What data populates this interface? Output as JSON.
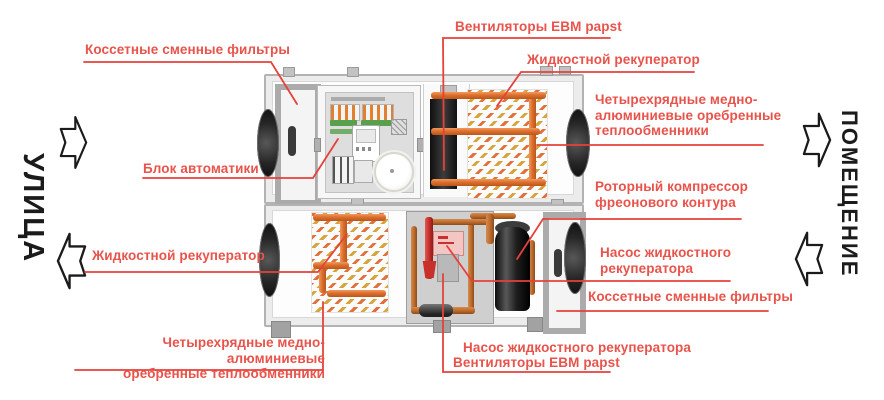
{
  "diagram_type": "air-handling-unit-schematic",
  "palette": {
    "accent_red_lines": "#e6413a",
    "label_red": "#e8534b",
    "flow_text_black": "#1b1b1b",
    "pipe_orange": "#dd6f2e",
    "coil_yellow": "#d6a43a",
    "metal_gray": "#ababab"
  },
  "flow": {
    "left_label": "УЛИЦА",
    "right_label": "ПОМЕЩЕНИЕ"
  },
  "callouts": {
    "filters_top": "Коссетные сменные фильтры",
    "automation_unit": "Блок автоматики",
    "fans_top": "Вентиляторы EBM papst",
    "liquid_recuperator_top": "Жидкостной рекуператор",
    "heat_exchangers_right": "Четырехрядные медно-\nалюминиевые оребренные\nтеплообменники",
    "rotary_compressor": "Роторный компрессор\nфреонового контура",
    "recuperator_pump_right": "Насос жидкостного\nрекуператора",
    "filters_right": "Коссетные сменные фильтры",
    "recuperator_pump_bottom": "Насос жидкостного рекуператора",
    "fans_bottom": "Вентиляторы EBM papst",
    "liquid_recuperator_left": "Жидкостной рекуператор",
    "heat_exchangers_bottom": "Четырехрядные медно-алюминиевые\nоребренные теплообменники"
  }
}
